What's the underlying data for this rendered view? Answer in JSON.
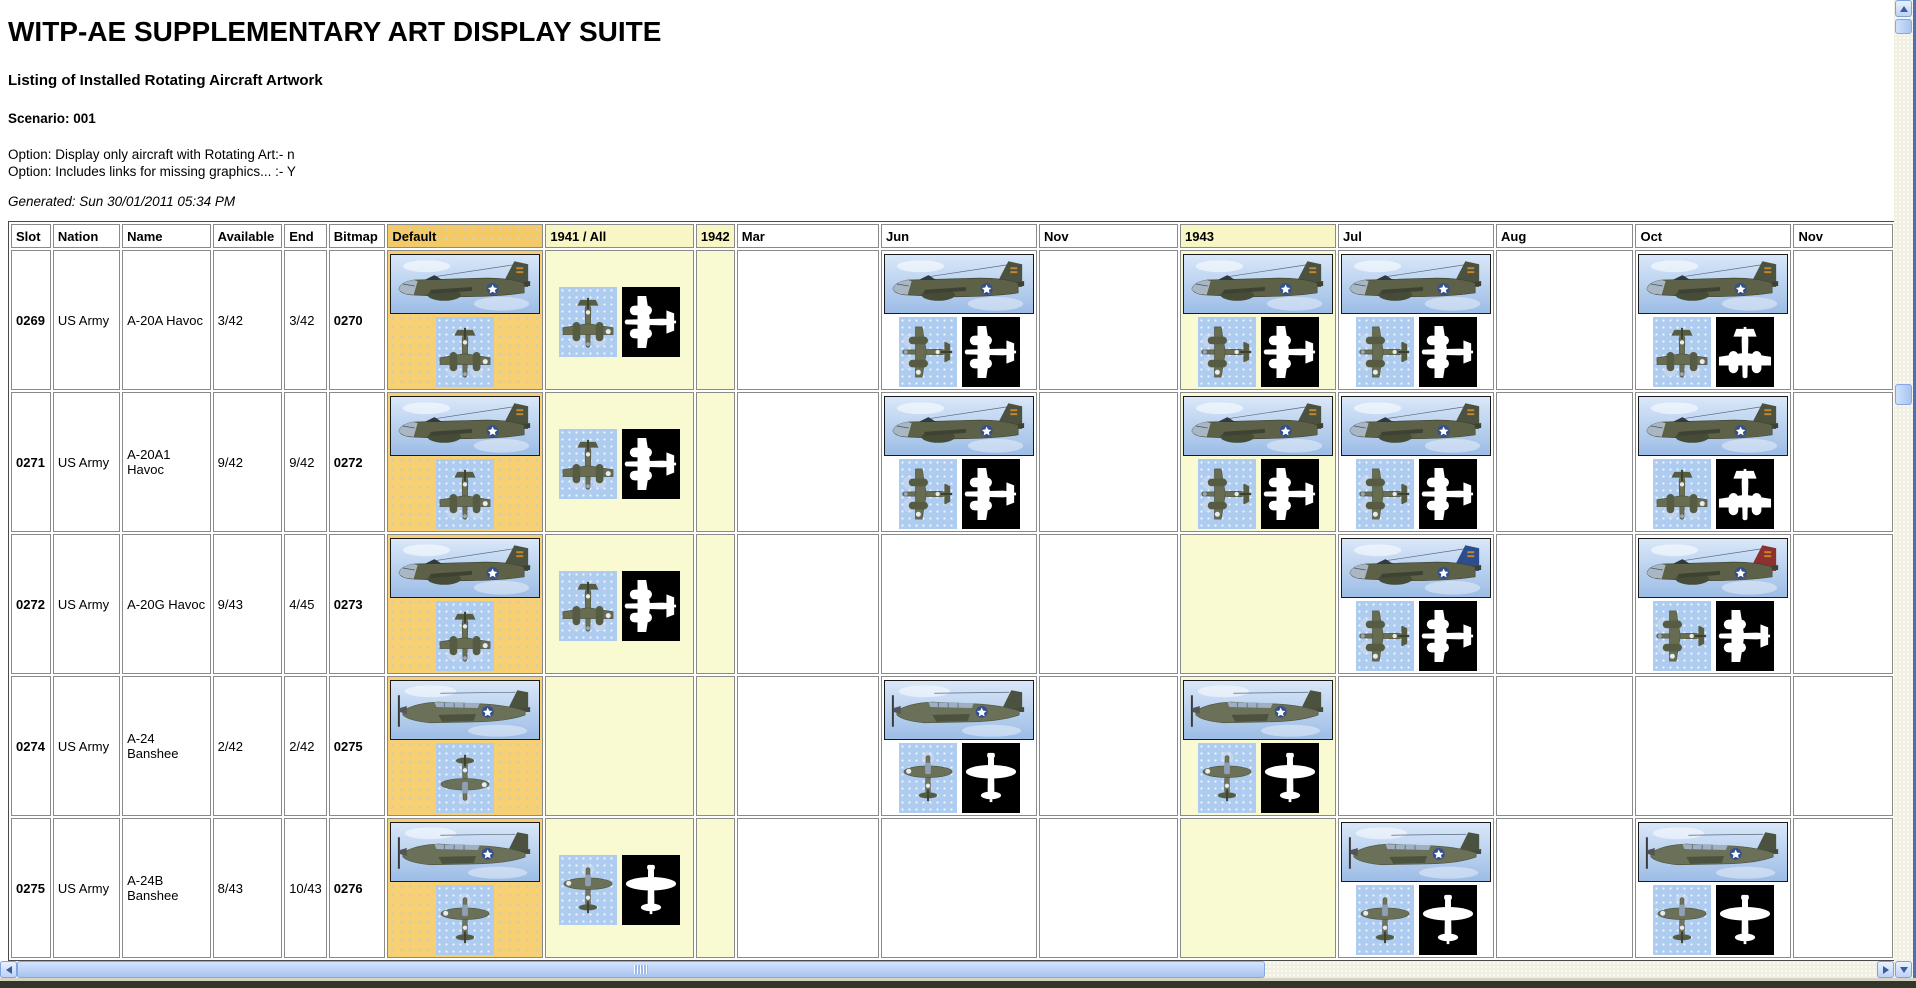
{
  "header": {
    "title": "WITP-AE SUPPLEMENTARY ART DISPLAY SUITE",
    "subtitle": "Listing of Installed Rotating Aircraft Artwork",
    "scenario": "Scenario: 001",
    "option1": "Option: Display only aircraft with Rotating Art:- n",
    "option2": "Option: Includes links for missing graphics... :- Y",
    "generated": "Generated: Sun 30/01/2011 05:34 PM"
  },
  "colors": {
    "default_column_orange": "#f7d074",
    "year_column_yellow": "#fafad2",
    "topview_blue": "#aecbf0",
    "silhouette_black": "#000000",
    "scrollbar_blue": "#a8c3ef"
  },
  "table": {
    "columns": [
      {
        "key": "slot",
        "label": "Slot",
        "bg": "white"
      },
      {
        "key": "nation",
        "label": "Nation",
        "bg": "white"
      },
      {
        "key": "name",
        "label": "Name",
        "bg": "white"
      },
      {
        "key": "available",
        "label": "Available",
        "bg": "white"
      },
      {
        "key": "end",
        "label": "End",
        "bg": "white"
      },
      {
        "key": "bitmap",
        "label": "Bitmap",
        "bg": "white"
      },
      {
        "key": "default",
        "label": "Default",
        "bg": "orange"
      },
      {
        "key": "y1941",
        "label": "1941 / All",
        "bg": "yellow"
      },
      {
        "key": "y1942",
        "label": "1942",
        "bg": "yellow"
      },
      {
        "key": "mar",
        "label": "Mar",
        "bg": "white"
      },
      {
        "key": "jun",
        "label": "Jun",
        "bg": "white"
      },
      {
        "key": "nov1",
        "label": "Nov",
        "bg": "white"
      },
      {
        "key": "y1943",
        "label": "1943",
        "bg": "yellow"
      },
      {
        "key": "jul",
        "label": "Jul",
        "bg": "white"
      },
      {
        "key": "aug",
        "label": "Aug",
        "bg": "white"
      },
      {
        "key": "oct",
        "label": "Oct",
        "bg": "white"
      },
      {
        "key": "nov2",
        "label": "Nov",
        "bg": "white"
      }
    ],
    "art_columns": [
      "default",
      "y1941",
      "y1942",
      "mar",
      "jun",
      "nov1",
      "y1943",
      "jul",
      "aug",
      "oct",
      "nov2"
    ],
    "rows": [
      {
        "slot": "0269",
        "nation": "US Army",
        "name": "A-20A Havoc",
        "available": "3/42",
        "end": "3/42",
        "bitmap": "0270",
        "plane": "twin",
        "art": {
          "default": [
            {
              "k": "side"
            },
            {
              "k": "top",
              "o": "down"
            }
          ],
          "y1941": [
            {
              "k": "top",
              "o": "down"
            },
            {
              "k": "sil",
              "o": "left"
            }
          ],
          "jun": [
            {
              "k": "side"
            },
            {
              "k": "top",
              "o": "left"
            },
            {
              "k": "sil",
              "o": "left"
            }
          ],
          "y1943": [
            {
              "k": "side"
            },
            {
              "k": "top",
              "o": "left"
            },
            {
              "k": "sil",
              "o": "left"
            }
          ],
          "jul": [
            {
              "k": "side"
            },
            {
              "k": "top",
              "o": "left"
            },
            {
              "k": "sil",
              "o": "left"
            }
          ],
          "oct": [
            {
              "k": "side"
            },
            {
              "k": "top",
              "o": "down"
            },
            {
              "k": "sil",
              "o": "down"
            }
          ]
        }
      },
      {
        "slot": "0271",
        "nation": "US Army",
        "name": "A-20A1 Havoc",
        "available": "9/42",
        "end": "9/42",
        "bitmap": "0272",
        "plane": "twin",
        "art": {
          "default": [
            {
              "k": "side"
            },
            {
              "k": "top",
              "o": "down"
            }
          ],
          "y1941": [
            {
              "k": "top",
              "o": "down"
            },
            {
              "k": "sil",
              "o": "left"
            }
          ],
          "jun": [
            {
              "k": "side"
            },
            {
              "k": "top",
              "o": "left"
            },
            {
              "k": "sil",
              "o": "left"
            }
          ],
          "y1943": [
            {
              "k": "side"
            },
            {
              "k": "top",
              "o": "left"
            },
            {
              "k": "sil",
              "o": "left"
            }
          ],
          "jul": [
            {
              "k": "side"
            },
            {
              "k": "top",
              "o": "left"
            },
            {
              "k": "sil",
              "o": "left"
            }
          ],
          "oct": [
            {
              "k": "side"
            },
            {
              "k": "top",
              "o": "down"
            },
            {
              "k": "sil",
              "o": "down"
            }
          ]
        }
      },
      {
        "slot": "0272",
        "nation": "US Army",
        "name": "A-20G Havoc",
        "available": "9/43",
        "end": "4/45",
        "bitmap": "0273",
        "plane": "twin",
        "art": {
          "default": [
            {
              "k": "side"
            },
            {
              "k": "top",
              "o": "down"
            }
          ],
          "y1941": [
            {
              "k": "top",
              "o": "down"
            },
            {
              "k": "sil",
              "o": "left"
            }
          ],
          "jul": [
            {
              "k": "side",
              "v": "blue"
            },
            {
              "k": "top",
              "o": "left"
            },
            {
              "k": "sil",
              "o": "left"
            }
          ],
          "oct": [
            {
              "k": "side",
              "v": "red"
            },
            {
              "k": "top",
              "o": "left"
            },
            {
              "k": "sil",
              "o": "left"
            }
          ]
        }
      },
      {
        "slot": "0274",
        "nation": "US Army",
        "name": "A-24 Banshee",
        "available": "2/42",
        "end": "2/42",
        "bitmap": "0275",
        "plane": "single",
        "art": {
          "default": [
            {
              "k": "side"
            },
            {
              "k": "top",
              "o": "down"
            }
          ],
          "jun": [
            {
              "k": "side"
            },
            {
              "k": "top",
              "o": "up"
            },
            {
              "k": "sil",
              "o": "up"
            }
          ],
          "y1943": [
            {
              "k": "side"
            },
            {
              "k": "top",
              "o": "up"
            },
            {
              "k": "sil",
              "o": "up"
            }
          ]
        }
      },
      {
        "slot": "0275",
        "nation": "US Army",
        "name": "A-24B Banshee",
        "available": "8/43",
        "end": "10/43",
        "bitmap": "0276",
        "plane": "single",
        "art": {
          "default": [
            {
              "k": "side"
            },
            {
              "k": "top",
              "o": "up"
            }
          ],
          "y1941": [
            {
              "k": "top",
              "o": "up"
            },
            {
              "k": "sil",
              "o": "up"
            }
          ],
          "jul": [
            {
              "k": "side"
            },
            {
              "k": "top",
              "o": "up"
            },
            {
              "k": "sil",
              "o": "up"
            }
          ],
          "oct": [
            {
              "k": "side"
            },
            {
              "k": "top",
              "o": "up"
            },
            {
              "k": "sil",
              "o": "up"
            }
          ]
        }
      }
    ]
  }
}
